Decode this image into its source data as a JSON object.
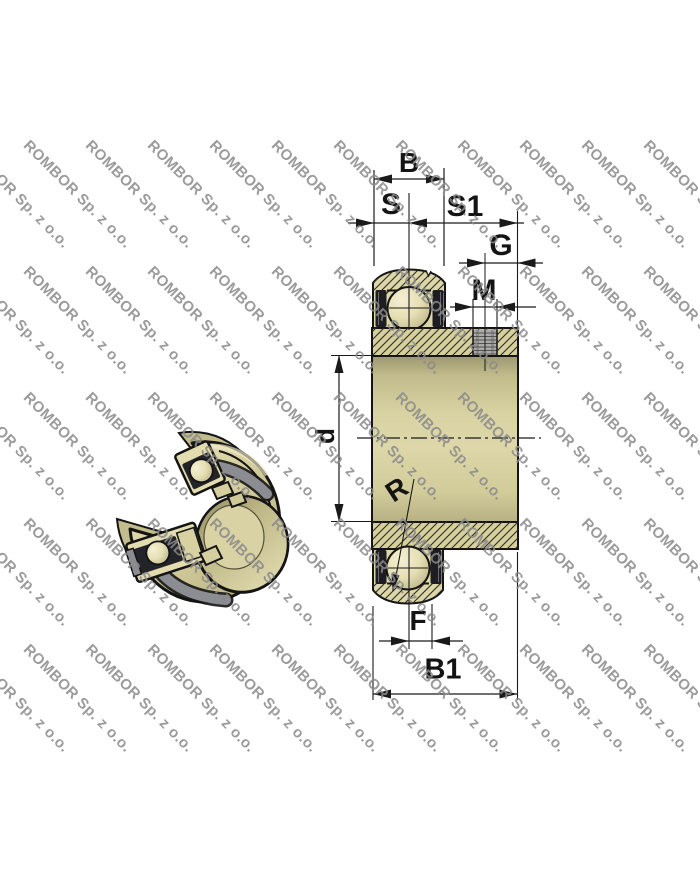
{
  "watermark": {
    "text": "ROMBOR Sp. z o.o.",
    "color": "#8a8a8a"
  },
  "labels": {
    "B": "B",
    "S": "S",
    "S1": "S1",
    "G": "G",
    "M": "M",
    "d": "d",
    "R": "R",
    "F": "F",
    "B1": "B1"
  },
  "colors": {
    "background": "#ffffff",
    "material_khaki": "#d7d09d",
    "seal_dark": "#23232a",
    "seal_gray": "#8c8c93",
    "drawing_line": "#1a1a1a"
  }
}
